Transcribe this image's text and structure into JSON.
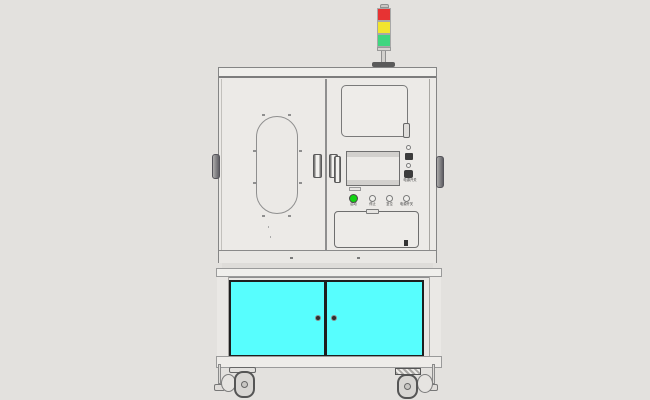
{
  "meta": {
    "background_color": "#e3e1de"
  },
  "colors": {
    "cabinet_face": "#eceae7",
    "frame_line": "#8a8a8a",
    "door_frame_dark": "#1e1e1e",
    "hardware_dark": "#3c3c3c"
  },
  "tower_light": {
    "segments": [
      {
        "name": "red",
        "color": "#e73333"
      },
      {
        "name": "yellow",
        "color": "#f2e52e"
      },
      {
        "name": "green",
        "color": "#3fd67f"
      }
    ]
  },
  "control_panel": {
    "side_label": "电源开关",
    "buttons": [
      {
        "label": "启动",
        "color": "#12d412"
      },
      {
        "label": "停止",
        "color": "#f0efec"
      },
      {
        "label": "复位",
        "color": "#f0efec"
      },
      {
        "label": "电源开关",
        "color": "#f0efec"
      }
    ]
  },
  "lower_cabinet": {
    "left_door_color": "#57fefe",
    "right_door_color": "#57fefe"
  }
}
